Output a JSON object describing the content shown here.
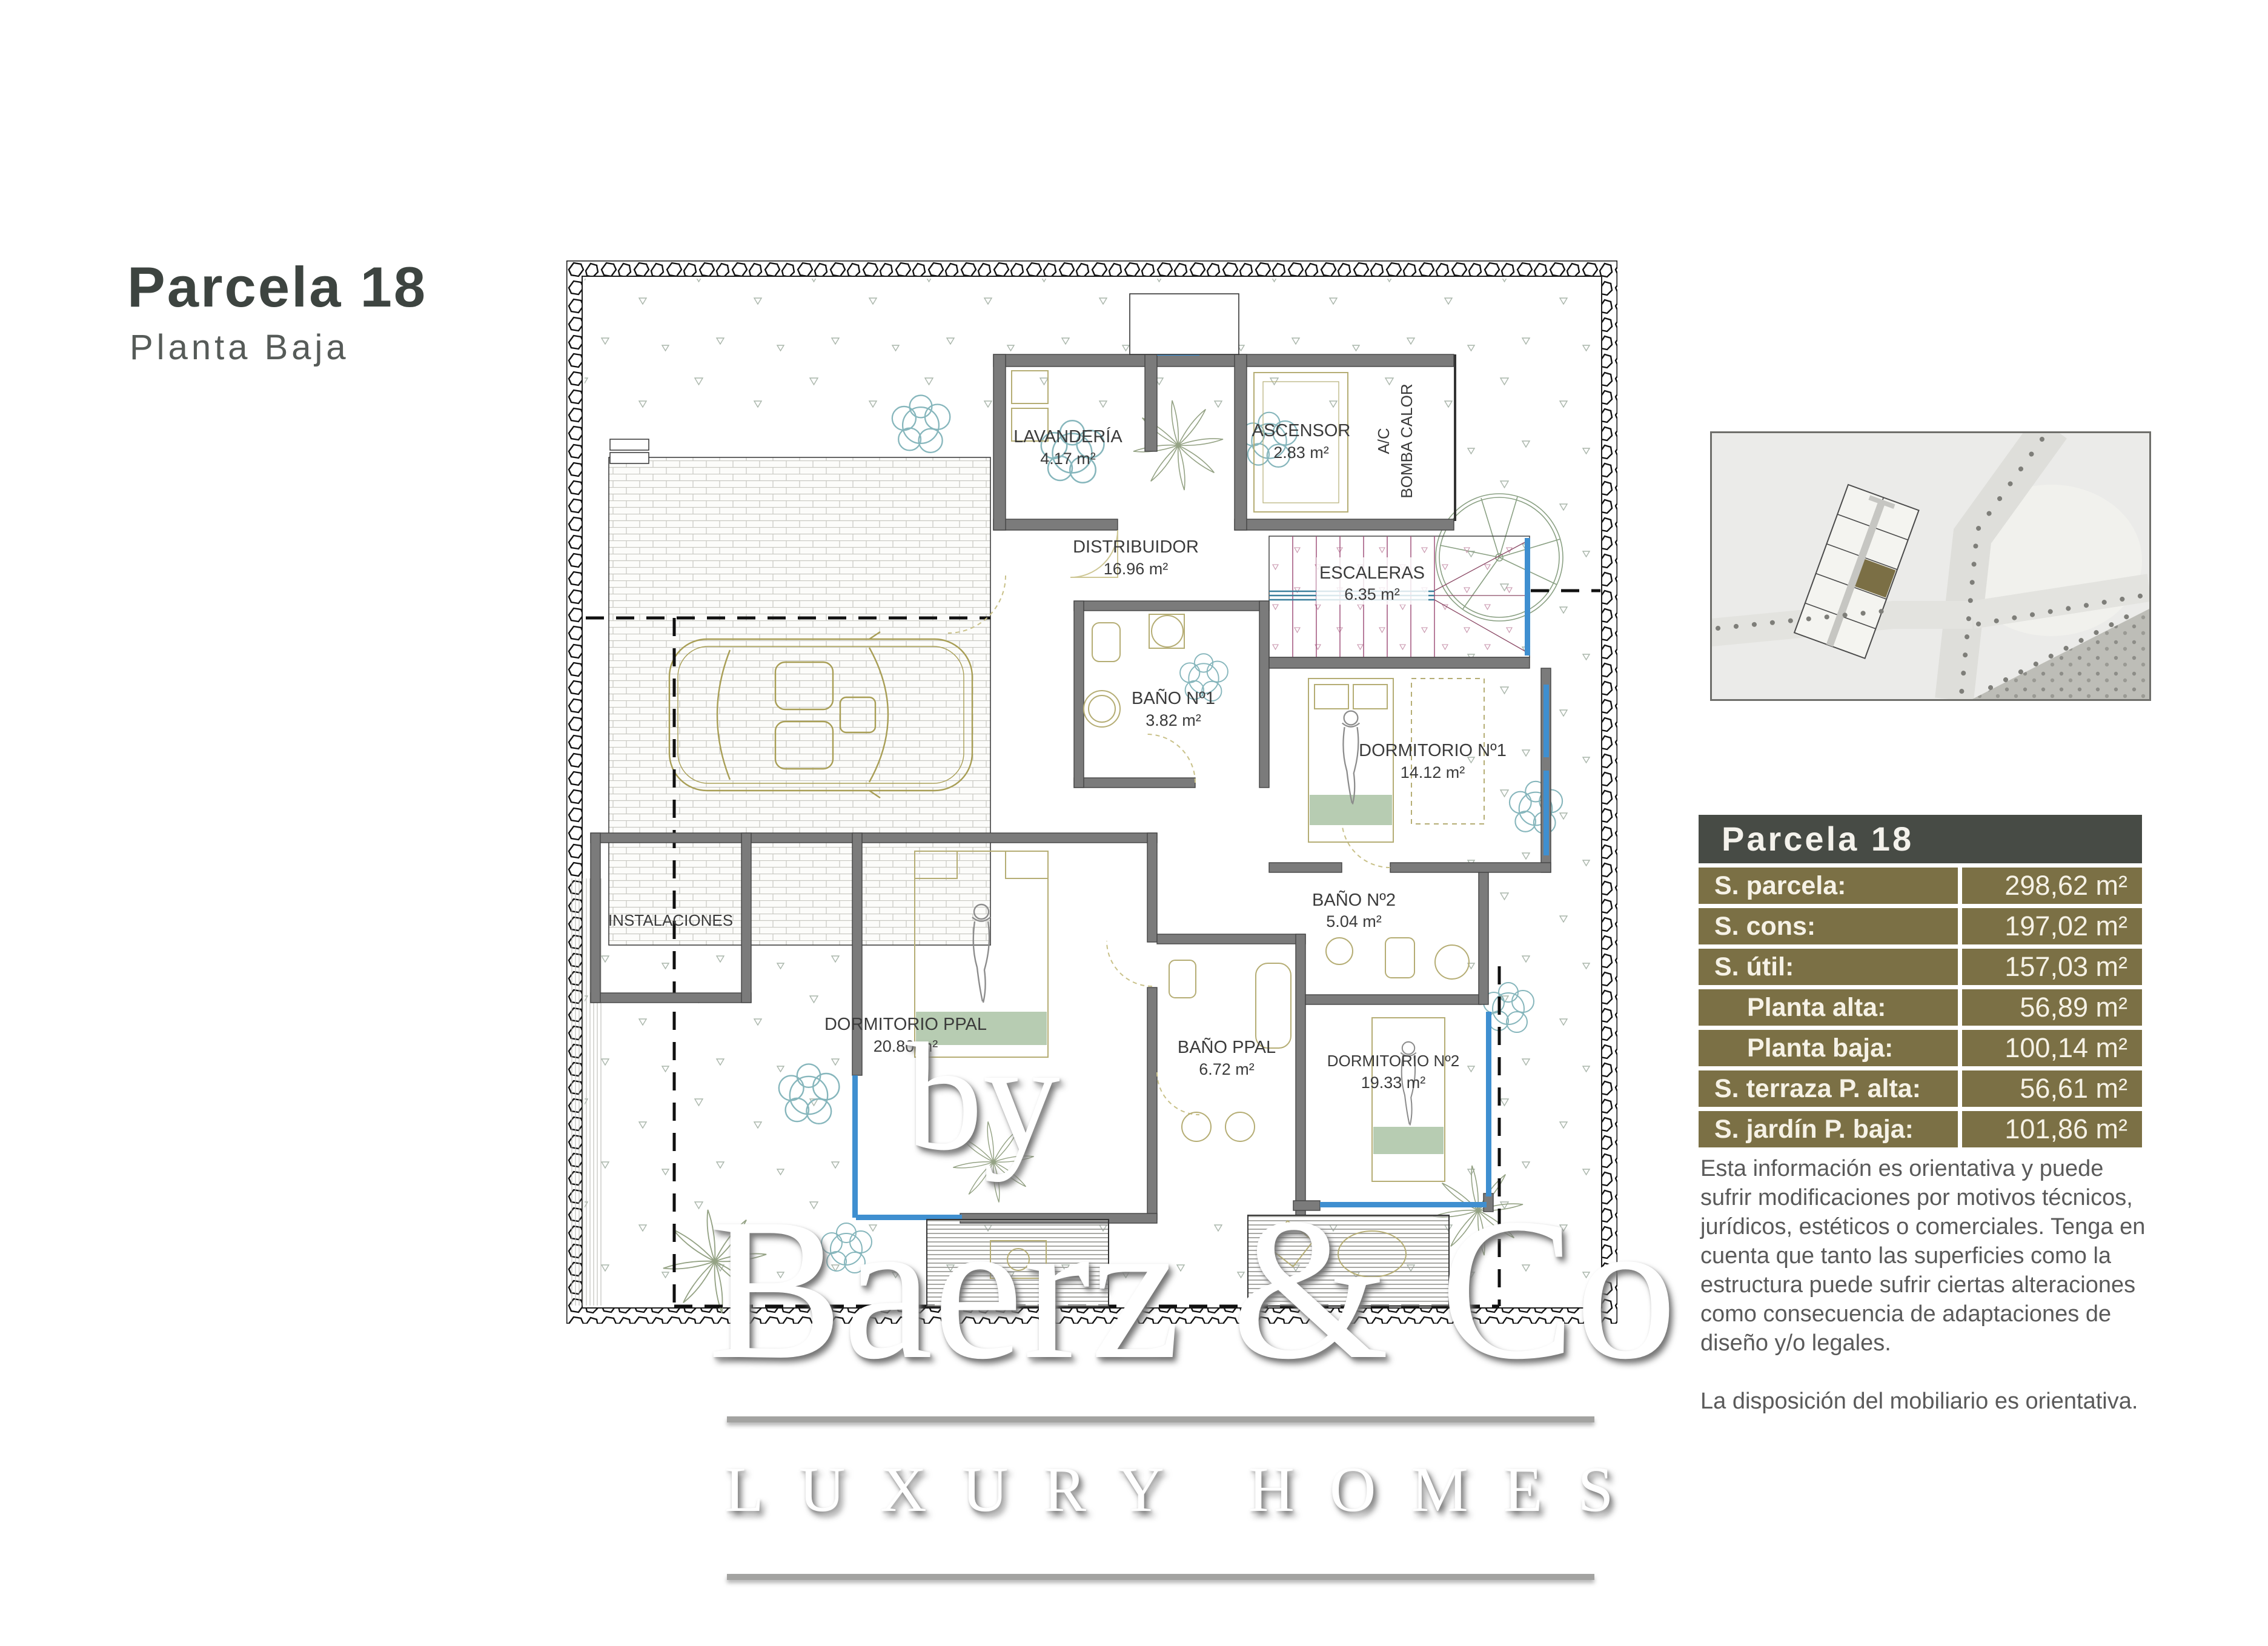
{
  "page": {
    "title": "Parcela 18",
    "subtitle": "Planta Baja"
  },
  "plan": {
    "rooms": [
      {
        "name": "LAVANDERÍA",
        "area": "4.17 m²"
      },
      {
        "name": "ASCENSOR",
        "area": "2.83 m²"
      },
      {
        "name": "A/C",
        "name2": "BOMBA CALOR",
        "area": ""
      },
      {
        "name": "ESCALERAS",
        "area": "6.35 m²"
      },
      {
        "name": "DISTRIBUIDOR",
        "area": "16.96 m²"
      },
      {
        "name": "BAÑO Nº1",
        "area": "3.82 m²"
      },
      {
        "name": "DORMITORIO Nº1",
        "area": "14.12 m²"
      },
      {
        "name": "BAÑO Nº2",
        "area": "5.04 m²"
      },
      {
        "name": "INSTALACIONES",
        "area": ""
      },
      {
        "name": "DORMITORIO PPAL",
        "area": "20.80 m²"
      },
      {
        "name": "BAÑO PPAL",
        "area": "6.72 m²"
      },
      {
        "name": "DORMITORIO Nº2",
        "area": "19.33 m²"
      }
    ]
  },
  "summary_table": {
    "header": "Parcela 18",
    "rows": [
      {
        "label": "S. parcela:",
        "value": "298,62 m²"
      },
      {
        "label": "S. cons:",
        "value": "197,02 m²"
      },
      {
        "label": "S. útil:",
        "value": "157,03 m²"
      },
      {
        "label": "Planta alta:",
        "value": "56,89 m²"
      },
      {
        "label": "Planta baja:",
        "value": "100,14 m²"
      },
      {
        "label": "S. terraza P. alta:",
        "value": "56,61 m²"
      },
      {
        "label": "S. jardín P. baja:",
        "value": "101,86 m²"
      }
    ]
  },
  "disclaimer": {
    "paragraph1": "Esta información es orientativa y puede sufrir modificaciones por motivos técnicos, jurídicos, estéticos o comerciales. Tenga en cuenta que tanto las superficies como la estructura puede sufrir ciertas alteraciones como consecuencia de adaptaciones de diseño y/o legales.",
    "paragraph2": "La disposición del mobiliario es orientativa."
  },
  "watermark": {
    "by": "by",
    "brand": "Baerz & Co",
    "tagline": "LUXURY HOMES"
  },
  "colors": {
    "table_header_bg": "#474b45",
    "table_row_bg": "#7b7045",
    "title_text": "#3d4440",
    "window_blue": "#3f8fd0",
    "highlight_parcel": "#7b6f45"
  }
}
